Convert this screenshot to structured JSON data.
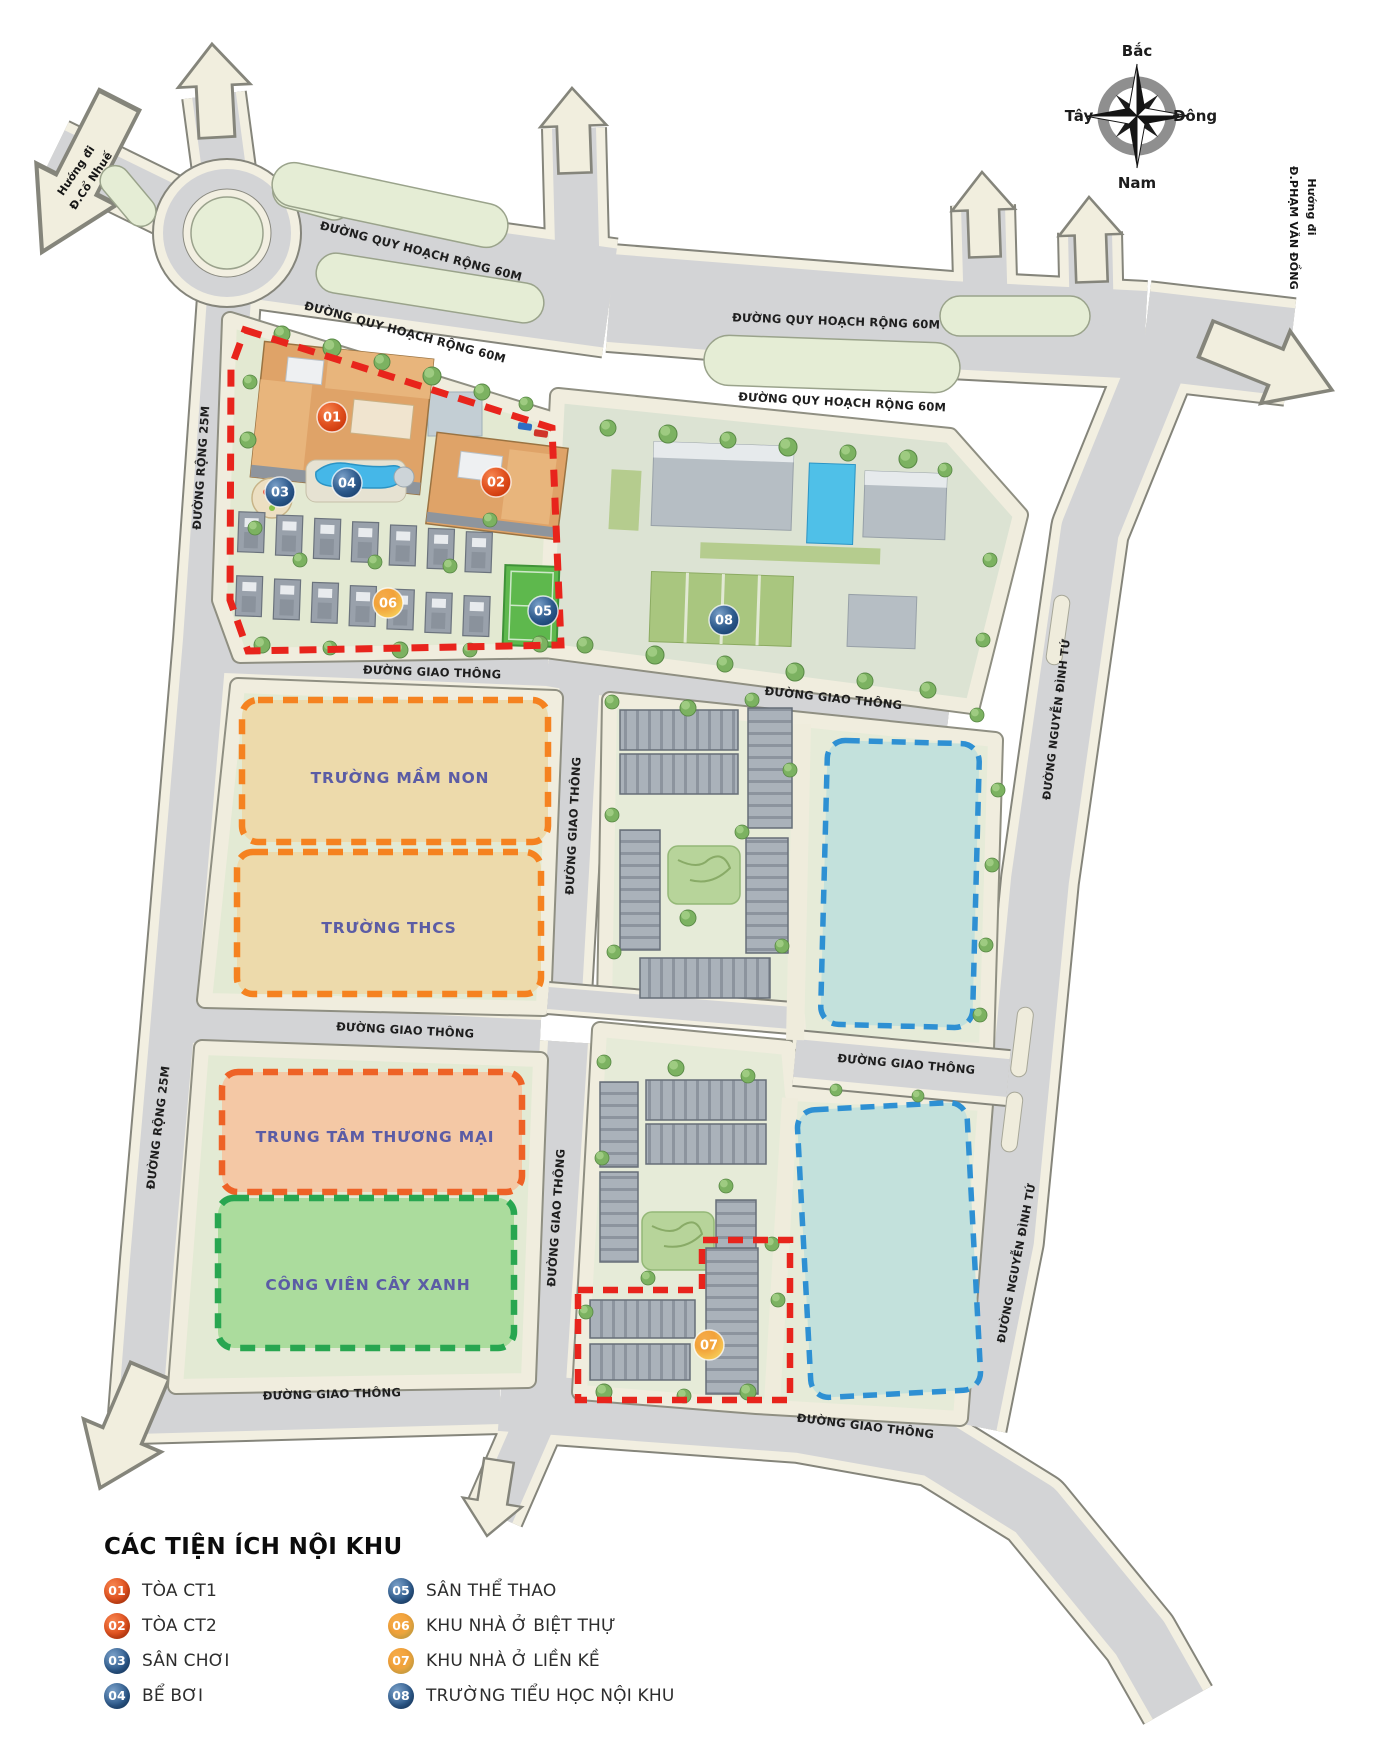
{
  "compass": {
    "north": "Bắc",
    "east": "Đông",
    "south": "Nam",
    "west": "Tây"
  },
  "signs": {
    "co_nhue_1": "Hướng đi",
    "co_nhue_2": "Đ.Cổ Nhuế",
    "pvd_1": "Hướng đi",
    "pvd_2": "Đ.PHẠM VĂN ĐỒNG"
  },
  "roads": {
    "quy_hoach_60m": "ĐƯỜNG QUY HOẠCH RỘNG 60M",
    "rong_25m": "ĐƯỜNG RỘNG 25M",
    "giao_thong": "ĐƯỜNG GIAO THÔNG",
    "nguyen_dinh_tu": "ĐƯỜNG NGUYỄN ĐÌNH TỨ"
  },
  "zones": {
    "mam_non": "TRƯỜNG MẦM NON",
    "thcs": "TRƯỜNG THCS",
    "thuong_mai": "TRUNG TÂM THƯƠNG MẠI",
    "cong_vien": "CÔNG VIÊN CÂY XANH"
  },
  "markers": [
    {
      "num": "01",
      "color": "red"
    },
    {
      "num": "02",
      "color": "red"
    },
    {
      "num": "03",
      "color": "blue"
    },
    {
      "num": "04",
      "color": "blue"
    },
    {
      "num": "05",
      "color": "blue"
    },
    {
      "num": "06",
      "color": "orange"
    },
    {
      "num": "07",
      "color": "orange"
    },
    {
      "num": "08",
      "color": "blue"
    }
  ],
  "legend": {
    "title": "CÁC TIỆN ÍCH NỘI KHU",
    "items": [
      {
        "num": "01",
        "label": "TÒA CT1",
        "color": "red"
      },
      {
        "num": "02",
        "label": "TÒA CT2",
        "color": "red"
      },
      {
        "num": "03",
        "label": "SÂN CHƠI",
        "color": "blue"
      },
      {
        "num": "04",
        "label": "BỂ BƠI",
        "color": "blue"
      },
      {
        "num": "05",
        "label": "SÂN THỂ THAO",
        "color": "blue"
      },
      {
        "num": "06",
        "label": "KHU NHÀ Ở BIỆT THỰ",
        "color": "orange"
      },
      {
        "num": "07",
        "label": "KHU NHÀ Ở LIỀN KỀ",
        "color": "orange"
      },
      {
        "num": "08",
        "label": "TRƯỜNG TIỂU HỌC NỘI KHU",
        "color": "blue"
      }
    ]
  },
  "colors": {
    "boundary_red": "#e8241c",
    "boundary_orange": "#f58220",
    "boundary_green": "#28a650",
    "boundary_blue": "#2e90d3",
    "zone_label_text": "#5b5ca5",
    "marker_red": "#d84012",
    "marker_blue": "#1d4a7d",
    "marker_orange": "#f2a23a"
  }
}
